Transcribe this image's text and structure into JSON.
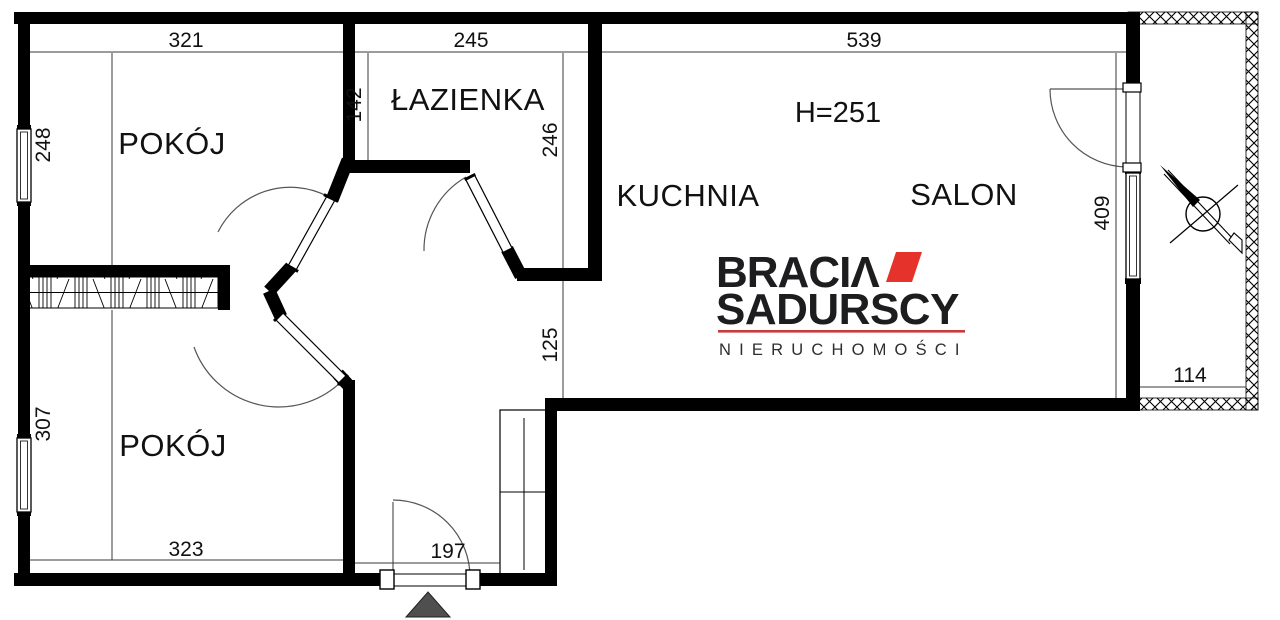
{
  "plan": {
    "labels": {
      "room_top": "POKÓJ",
      "bathroom": "ŁAZIENKA",
      "kitchen": "KUCHNIA",
      "living_room": "SALON",
      "room_bottom": "POKÓJ",
      "ceiling_height": "H=251"
    },
    "dims": {
      "top_room_width": "321",
      "bathroom_width": "245",
      "living_width": "539",
      "top_room_height": "248",
      "bathroom_left_height": "142",
      "bathroom_right_height": "246",
      "passage_opening": "125",
      "living_right_height": "409",
      "balcony_width": "114",
      "bottom_room_height": "307",
      "bottom_room_width": "323",
      "hall_width": "197"
    },
    "colors": {
      "wall": "#000000",
      "background": "#ffffff",
      "entry_marker": "#4f4f4f"
    }
  },
  "logo": {
    "brand_line1": "BRACIΛ",
    "brand_line2": "SADURSCY",
    "tagline": "NIERUCHOMOŚCI",
    "accent_red": "#e5332b",
    "underline_red": "#c93a3f"
  }
}
